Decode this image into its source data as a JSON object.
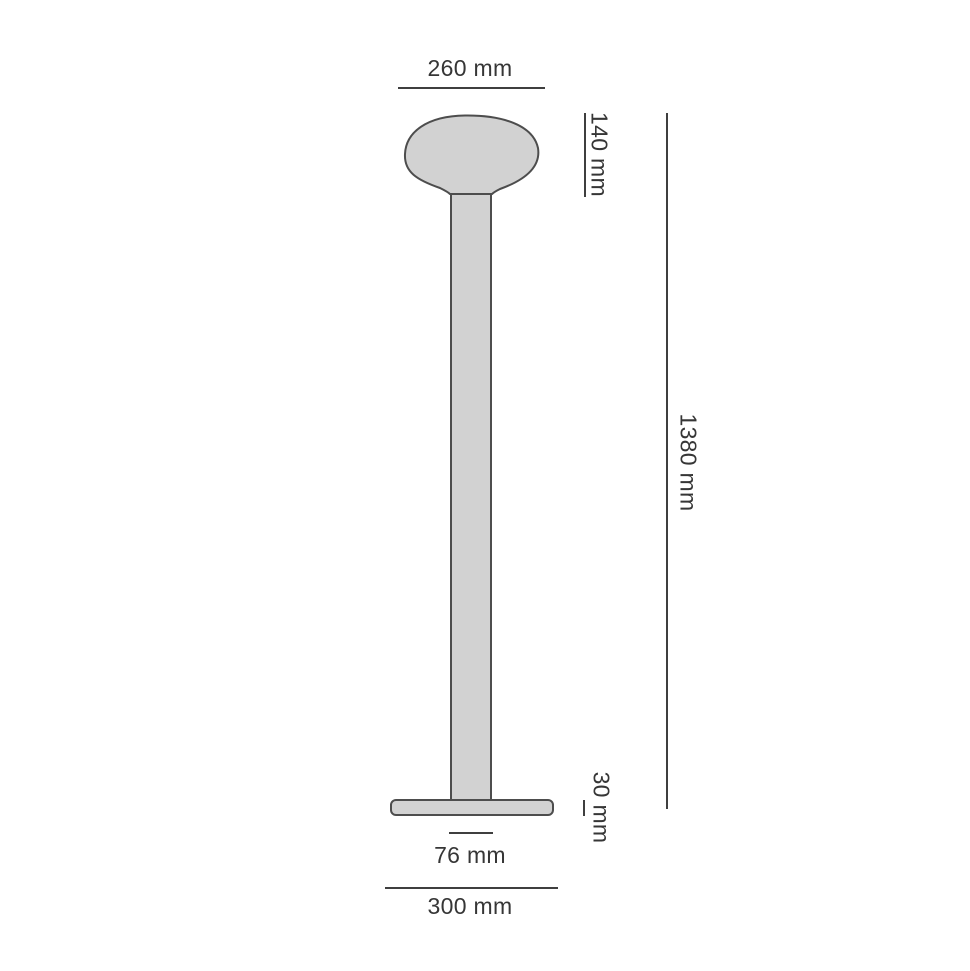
{
  "drawing": {
    "title": "floor-lamp-dimension-diagram",
    "colors": {
      "fill": "#d2d2d2",
      "outline": "#4d4d4d",
      "line": "#3f3f3f",
      "text": "#363636"
    },
    "dimensions": {
      "head_width": {
        "label": "260 mm"
      },
      "head_height": {
        "label": "140 mm"
      },
      "total_height": {
        "label": "1380 mm"
      },
      "base_height": {
        "label": "30 mm"
      },
      "stem_diameter": {
        "label": "76 mm"
      },
      "base_width": {
        "label": "300 mm"
      }
    }
  }
}
